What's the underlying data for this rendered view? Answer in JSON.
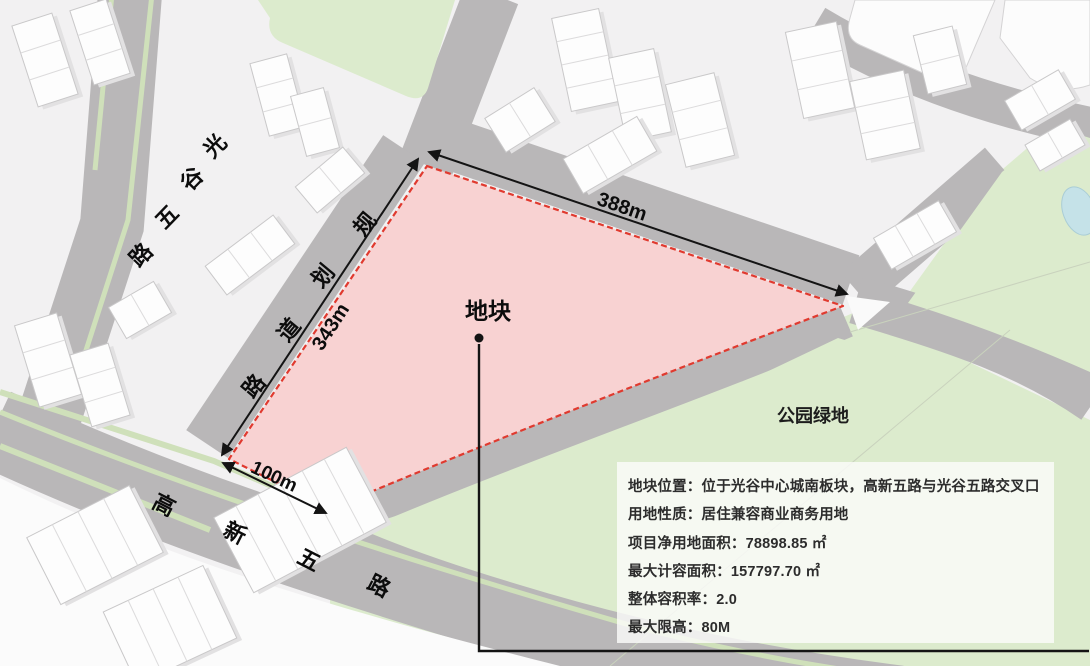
{
  "map": {
    "plot_label": "地块",
    "park_label": "公园绿地",
    "dimensions": {
      "north": "388m",
      "west": "343m",
      "south": "100m"
    },
    "roads": {
      "guanggu_wulu": {
        "name": "光谷五路",
        "chars": [
          "光",
          "谷",
          "五",
          "路"
        ]
      },
      "guihua_daolu": {
        "name": "规划道路",
        "chars": [
          "规",
          "划",
          "道",
          "路"
        ]
      },
      "gaoxin_wulu": {
        "name": "高新五路",
        "chars": [
          "高",
          "新",
          "五",
          "路"
        ]
      }
    },
    "colors": {
      "plot_fill": "#f8d2d2",
      "plot_border": "#e03a2f",
      "road_gray": "#b9b7b8",
      "park_green": "#dcebcd",
      "verge_green": "#cfe0ba",
      "pond_blue": "#c5e2e8"
    }
  },
  "info_panel": {
    "lines": [
      "地块位置：位于光谷中心城南板块，高新五路与光谷五路交叉口",
      "用地性质：居住兼容商业商务用地",
      "项目净用地面积：78898.85 ㎡",
      "最大计容面积：157797.70 ㎡",
      "整体容积率：2.0",
      "最大限高：80M"
    ]
  }
}
